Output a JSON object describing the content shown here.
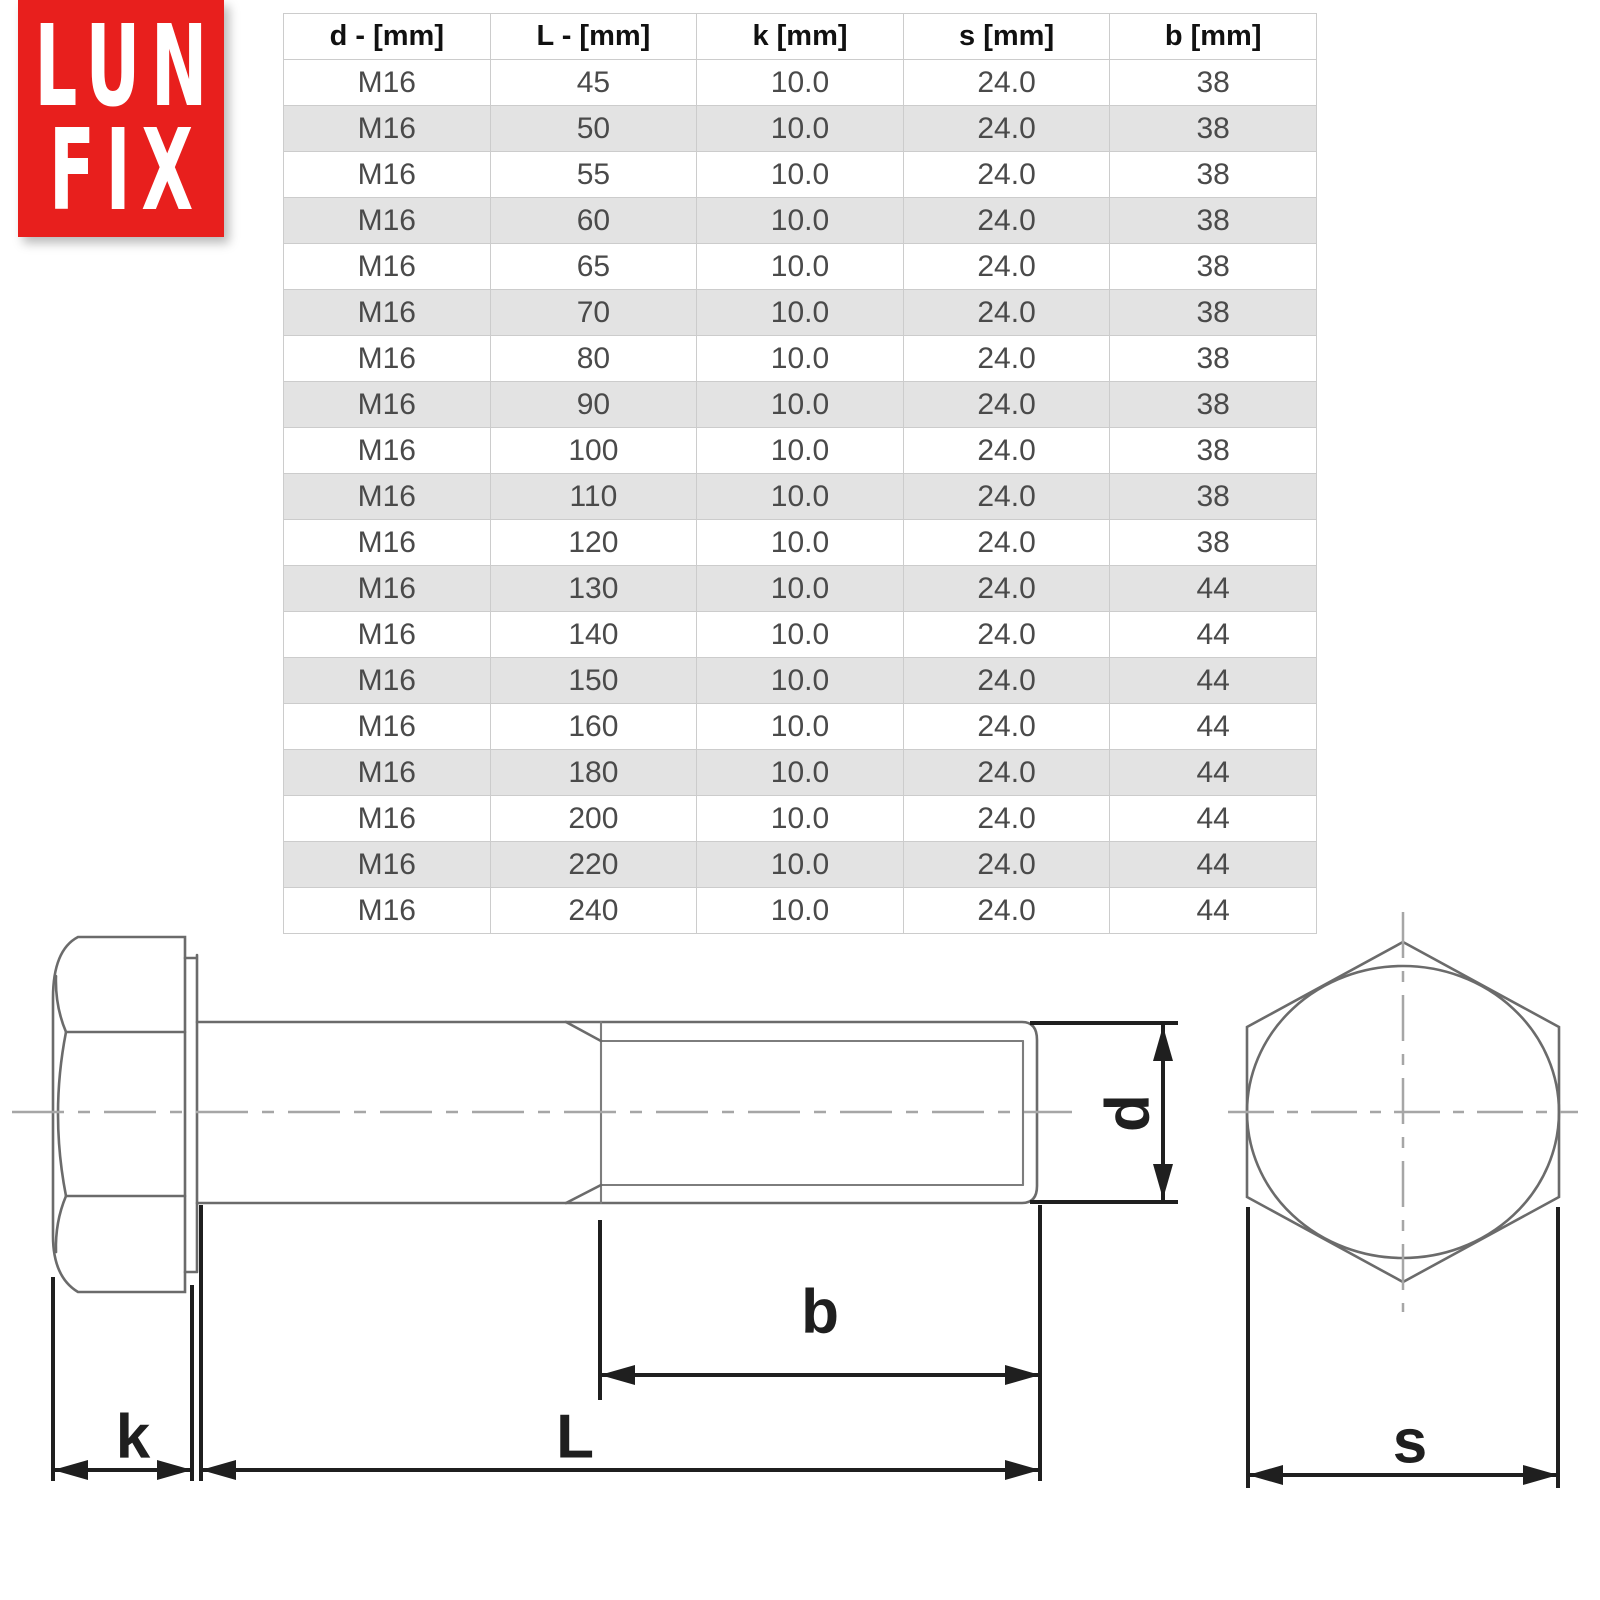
{
  "logo": {
    "line1": "LUN",
    "line2": "FIX",
    "bg_color": "#e81f1d",
    "text_color": "#ffffff"
  },
  "table": {
    "headers": [
      "d - [mm]",
      "L - [mm]",
      "k [mm]",
      "s [mm]",
      "b [mm]"
    ],
    "rows": [
      [
        "M16",
        "45",
        "10.0",
        "24.0",
        "38"
      ],
      [
        "M16",
        "50",
        "10.0",
        "24.0",
        "38"
      ],
      [
        "M16",
        "55",
        "10.0",
        "24.0",
        "38"
      ],
      [
        "M16",
        "60",
        "10.0",
        "24.0",
        "38"
      ],
      [
        "M16",
        "65",
        "10.0",
        "24.0",
        "38"
      ],
      [
        "M16",
        "70",
        "10.0",
        "24.0",
        "38"
      ],
      [
        "M16",
        "80",
        "10.0",
        "24.0",
        "38"
      ],
      [
        "M16",
        "90",
        "10.0",
        "24.0",
        "38"
      ],
      [
        "M16",
        "100",
        "10.0",
        "24.0",
        "38"
      ],
      [
        "M16",
        "110",
        "10.0",
        "24.0",
        "38"
      ],
      [
        "M16",
        "120",
        "10.0",
        "24.0",
        "38"
      ],
      [
        "M16",
        "130",
        "10.0",
        "24.0",
        "44"
      ],
      [
        "M16",
        "140",
        "10.0",
        "24.0",
        "44"
      ],
      [
        "M16",
        "150",
        "10.0",
        "24.0",
        "44"
      ],
      [
        "M16",
        "160",
        "10.0",
        "24.0",
        "44"
      ],
      [
        "M16",
        "180",
        "10.0",
        "24.0",
        "44"
      ],
      [
        "M16",
        "200",
        "10.0",
        "24.0",
        "44"
      ],
      [
        "M16",
        "220",
        "10.0",
        "24.0",
        "44"
      ],
      [
        "M16",
        "240",
        "10.0",
        "24.0",
        "44"
      ]
    ],
    "stripe_color": "#e3e3e3",
    "border_color": "#cccccc"
  },
  "drawing": {
    "labels": {
      "k": "k",
      "L": "L",
      "b": "b",
      "d": "d",
      "s": "s"
    },
    "stroke_color": "#6b6b6b",
    "dimension_color": "#1f1f1f",
    "centerline_color": "#a6a6a6"
  }
}
